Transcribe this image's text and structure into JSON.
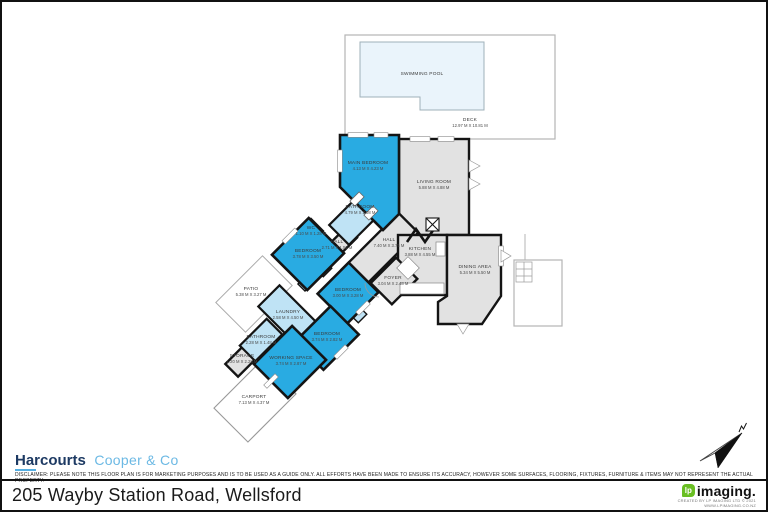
{
  "meta": {
    "address": "205 Wayby Station Road, Wellsford"
  },
  "branding": {
    "agency_name": "Harcourts",
    "agency_suffix": "Cooper & Co",
    "disclaimer": "DISCLAIMER: PLEASE NOTE THIS FLOOR PLAN IS FOR MARKETING PURPOSES AND IS TO BE USED AS A GUIDE ONLY. ALL EFFORTS HAVE BEEN MADE TO ENSURE ITS ACCURACY, HOWEVER SOME SURFACES, FLOORING, FIXTURES, FURNITURE & ITEMS MAY NOT REPRESENT THE ACTUAL PROPERTY.",
    "imaging_glyph": "lp",
    "imaging_brand": "imaging.",
    "imaging_credit": "CREATED BY LP IMAGING LTD © 2021",
    "imaging_url": "WWW.LPIMAGING.CO.NZ"
  },
  "colors": {
    "bedroom_fill": "#29abe2",
    "wet_area_fill": "#bfe3f5",
    "floor_fill": "#e2e2e2",
    "pool_fill": "#eaf4fb",
    "wall": "#141414",
    "harcourts_navy": "#1d3a63",
    "harcourts_blue": "#6cb9e4",
    "lp_green": "#6abf23"
  },
  "plan": {
    "rooms": [
      {
        "name": "SWIMMING POOL",
        "dims": ""
      },
      {
        "name": "DECK",
        "dims": "12.97 M X 10.81 M"
      },
      {
        "name": "MAIN BEDROOM",
        "dims": "4.13 M X 4.23 M"
      },
      {
        "name": "LIVING ROOM",
        "dims": "5.88 M X 4.88 M"
      },
      {
        "name": "BATHROOM",
        "dims": "4.79 M X 2.08 M"
      },
      {
        "name": "WC",
        "dims": "1.10 M X 1.28 M"
      },
      {
        "name": "HALL",
        "dims": "2.71 M X 1.52 M"
      },
      {
        "name": "HALL",
        "dims": "7.40 M X 3.75 M"
      },
      {
        "name": "BEDROOM",
        "dims": "3.78 M X 3.50 M"
      },
      {
        "name": "BEDROOM",
        "dims": "3.00 M X 3.28 M"
      },
      {
        "name": "KITCHEN",
        "dims": "3.88 M X 4.55 M"
      },
      {
        "name": "DINING AREA",
        "dims": "5.34 M X 5.50 M"
      },
      {
        "name": "FOYER",
        "dims": "3.04 M X 2.48 M"
      },
      {
        "name": "PATIO",
        "dims": "5.38 M X 3.27 M"
      },
      {
        "name": "LAUNDRY",
        "dims": "2.58 M X 4.50 M"
      },
      {
        "name": "BATHROOM",
        "dims": "2.28 M X 1.48 M"
      },
      {
        "name": "STORAGE",
        "dims": "1.20 M X 2.28 M"
      },
      {
        "name": "BEDROOM",
        "dims": "3.74 M X 2.82 M"
      },
      {
        "name": "WORKING SPACE",
        "dims": "3.74 M X 2.87 M"
      },
      {
        "name": "CARPORT",
        "dims": "7.13 M X 4.37 M"
      }
    ]
  }
}
